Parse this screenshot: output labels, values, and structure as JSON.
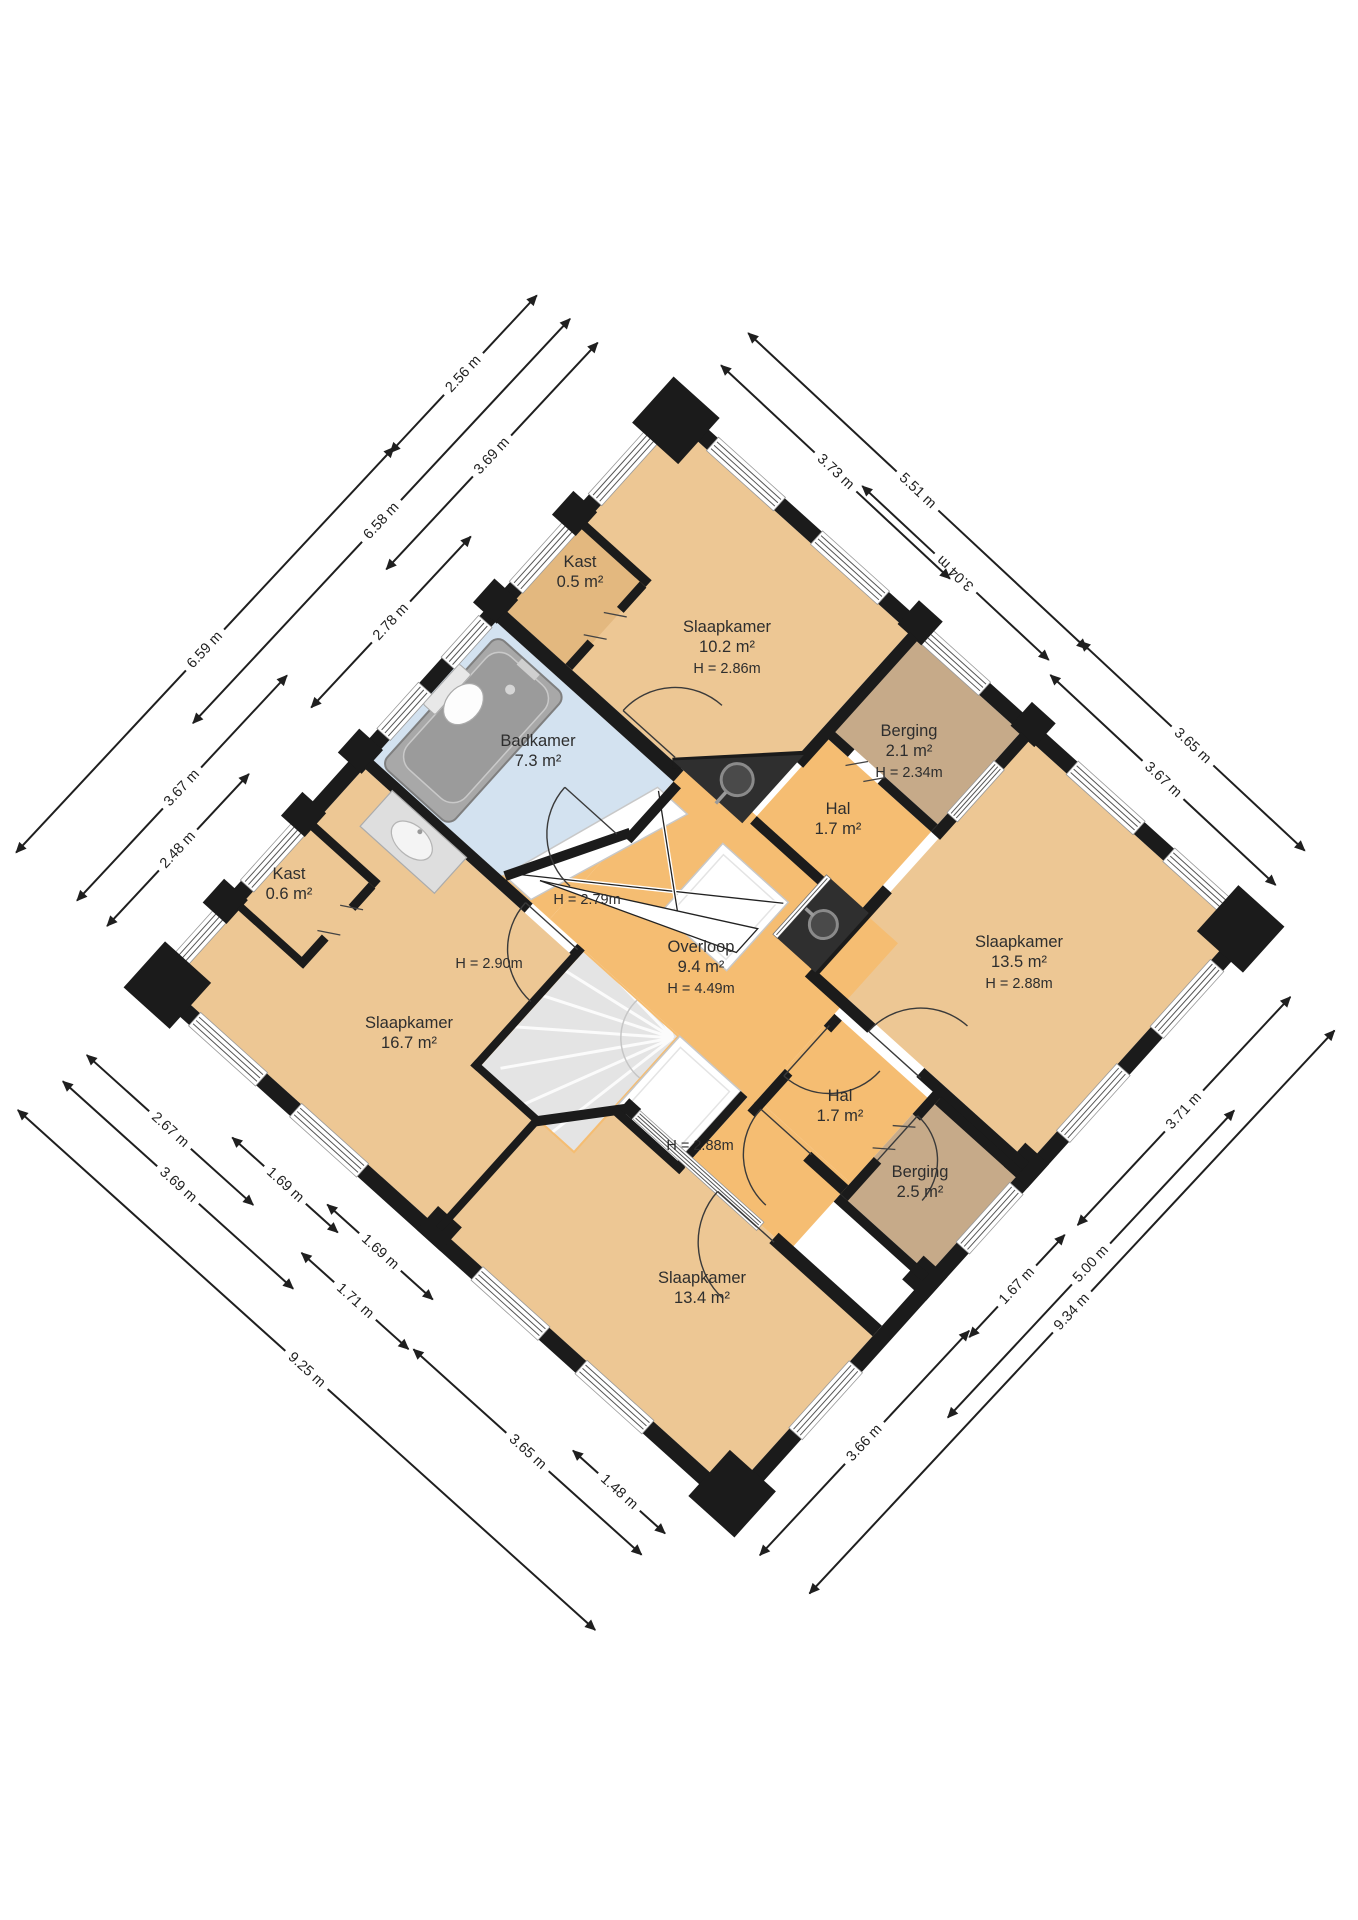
{
  "plan": {
    "floor_title": "",
    "rooms": [
      {
        "id": "kast-05",
        "name": "Kast",
        "area": "0.5 m²",
        "height": "",
        "x": 580,
        "y": 573
      },
      {
        "id": "slaapkamer-102",
        "name": "Slaapkamer",
        "area": "10.2 m²",
        "height": "H = 2.86m",
        "x": 727,
        "y": 648
      },
      {
        "id": "badkamer",
        "name": "Badkamer",
        "area": "7.3 m²",
        "height": "",
        "x": 538,
        "y": 752
      },
      {
        "id": "berging-21",
        "name": "Berging",
        "area": "2.1 m²",
        "height": "H = 2.34m",
        "x": 909,
        "y": 752
      },
      {
        "id": "hal-boven",
        "name": "Hal",
        "area": "1.7 m²",
        "height": "",
        "x": 838,
        "y": 820
      },
      {
        "id": "slaapkamer-135",
        "name": "Slaapkamer",
        "area": "13.5 m²",
        "height": "H = 2.88m",
        "x": 1019,
        "y": 963
      },
      {
        "id": "overloop",
        "name": "Overloop",
        "area": "9.4 m²",
        "height": "H = 4.49m",
        "x": 701,
        "y": 968
      },
      {
        "id": "kast-06",
        "name": "Kast",
        "area": "0.6 m²",
        "height": "",
        "x": 289,
        "y": 885
      },
      {
        "id": "slaapkamer-167",
        "name": "Slaapkamer",
        "area": "16.7 m²",
        "height": "",
        "x": 409,
        "y": 1034
      },
      {
        "id": "hal-beneden",
        "name": "Hal",
        "area": "1.7 m²",
        "height": "",
        "x": 840,
        "y": 1107
      },
      {
        "id": "berging-25",
        "name": "Berging",
        "area": "2.5 m²",
        "height": "",
        "x": 920,
        "y": 1183
      },
      {
        "id": "slaapkamer-134",
        "name": "Slaapkamer",
        "area": "13.4 m²",
        "height": "",
        "x": 702,
        "y": 1289
      }
    ],
    "height_labels": [
      {
        "text": "H = 2.79m",
        "x": 587,
        "y": 900
      },
      {
        "text": "H = 2.90m",
        "x": 489,
        "y": 964
      },
      {
        "text": "H = 2.88m",
        "x": 700,
        "y": 1146
      }
    ],
    "dimensions": [
      {
        "text": "2.56 m",
        "x": 463,
        "y": 374,
        "angle": -47,
        "len": 215
      },
      {
        "text": "3.69 m",
        "x": 492,
        "y": 456,
        "angle": -47,
        "len": 310
      },
      {
        "text": "6.58 m",
        "x": 381,
        "y": 521,
        "angle": -47,
        "len": 553
      },
      {
        "text": "6.59 m",
        "x": 205,
        "y": 650,
        "angle": -47,
        "len": 554
      },
      {
        "text": "2.78 m",
        "x": 391,
        "y": 622,
        "angle": -47,
        "len": 234
      },
      {
        "text": "3.67 m",
        "x": 182,
        "y": 788,
        "angle": -47,
        "len": 308
      },
      {
        "text": "2.48 m",
        "x": 178,
        "y": 850,
        "angle": -47,
        "len": 208
      },
      {
        "text": "3.73 m",
        "x": 835,
        "y": 472,
        "angle": 43,
        "len": 313
      },
      {
        "text": "5.51 m",
        "x": 917,
        "y": 491,
        "angle": 43,
        "len": 463
      },
      {
        "text": "3.04 m",
        "x": 955,
        "y": 573,
        "angle": 223,
        "len": 255
      },
      {
        "text": "3.65 m",
        "x": 1192,
        "y": 746,
        "angle": 43,
        "len": 307
      },
      {
        "text": "3.67 m",
        "x": 1163,
        "y": 780,
        "angle": 43,
        "len": 308
      },
      {
        "text": "3.71 m",
        "x": 1184,
        "y": 1111,
        "angle": -47,
        "len": 312
      },
      {
        "text": "1.67 m",
        "x": 1017,
        "y": 1286,
        "angle": -47,
        "len": 140
      },
      {
        "text": "5.00 m",
        "x": 1091,
        "y": 1264,
        "angle": -47,
        "len": 420
      },
      {
        "text": "9.34 m",
        "x": 1072,
        "y": 1312,
        "angle": -47,
        "len": 770
      },
      {
        "text": "3.66 m",
        "x": 864,
        "y": 1443,
        "angle": -47,
        "len": 307
      },
      {
        "text": "2.67 m",
        "x": 170,
        "y": 1130,
        "angle": 42,
        "len": 224
      },
      {
        "text": "3.69 m",
        "x": 178,
        "y": 1185,
        "angle": 42,
        "len": 310
      },
      {
        "text": "1.69 m",
        "x": 285,
        "y": 1185,
        "angle": 42,
        "len": 142
      },
      {
        "text": "1.69 m",
        "x": 380,
        "y": 1252,
        "angle": 42,
        "len": 142
      },
      {
        "text": "1.71 m",
        "x": 355,
        "y": 1301,
        "angle": 42,
        "len": 144
      },
      {
        "text": "9.25 m",
        "x": 306,
        "y": 1370,
        "angle": 42,
        "len": 777
      },
      {
        "text": "3.65 m",
        "x": 527,
        "y": 1452,
        "angle": 42,
        "len": 307
      },
      {
        "text": "1.48 m",
        "x": 619,
        "y": 1492,
        "angle": 42,
        "len": 124
      }
    ],
    "colors": {
      "room_orange": "#edc794",
      "circulation_orange": "#f5bd72",
      "closet_tan": "#e3b87f",
      "storage_brown": "#c6aa89",
      "bathroom_blue": "#d3e2f0",
      "wall_black": "#1b1b1b",
      "counter_dark": "#2f2f2f",
      "stairs_gray": "#e4e4e4",
      "text_dark": "#2e2e2e"
    }
  }
}
